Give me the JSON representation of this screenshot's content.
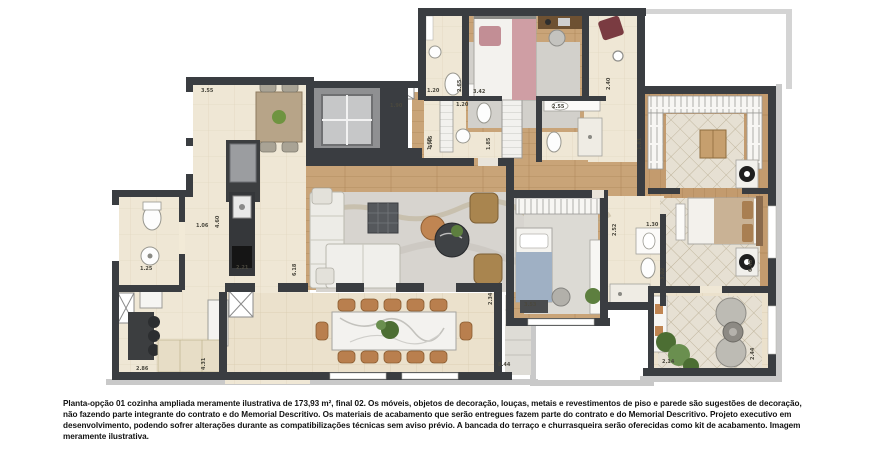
{
  "caption": {
    "text": "Planta-opção 01 cozinha ampliada meramente ilustrativa de 173,93 m², final 02. Os móveis, objetos de decoração, louças, metais e revestimentos de piso e parede são sugestões de decoração, não fazendo parte integrante do contrato e do Memorial Descritivo. Os materiais de acabamento que serão entregues fazem parte do contrato e do Memorial Descritivo. Projeto executivo em desenvolvimento, podendo sofrer alterações durante as compatibilizações técnicas sem aviso prévio. A bancada do terraço e churrasqueira serão oferecidas como kit de acabamento. Imagem meramente ilustrativa."
  },
  "floorplan": {
    "type": "apartment-floor-plan",
    "option_label": "Planta-opção 01",
    "area_label": "173,93 m²",
    "unit_label": "final 02",
    "colors": {
      "wall": "#3a3d41",
      "tile_floor": "#ebe1cc",
      "wood_floor": "#c9a478",
      "rug_gray": "#d7d4cf",
      "rug_diamond": "#e6e0d3",
      "accent_pink": "#d9a8ab",
      "accent_blue": "#9fb0c4",
      "furniture_tan": "#b97f4e",
      "greenery": "#5d7f3f",
      "exterior_trim": "#c9c9c9"
    },
    "dimension_labels": [
      {
        "v": "3.55",
        "x": 201,
        "y": 92,
        "rot": false
      },
      {
        "v": "1.90",
        "x": 390,
        "y": 107,
        "rot": false
      },
      {
        "v": "1.45",
        "x": 432,
        "y": 148,
        "rot": true
      },
      {
        "v": "1.20",
        "x": 427,
        "y": 92,
        "rot": false
      },
      {
        "v": "2.65",
        "x": 461,
        "y": 92,
        "rot": true
      },
      {
        "v": "3.42",
        "x": 473,
        "y": 93,
        "rot": false
      },
      {
        "v": "1.20",
        "x": 456,
        "y": 106,
        "rot": false
      },
      {
        "v": "1.65",
        "x": 431,
        "y": 150,
        "rot": true
      },
      {
        "v": "1.85",
        "x": 490,
        "y": 150,
        "rot": true
      },
      {
        "v": "2.55",
        "x": 552,
        "y": 108,
        "rot": false
      },
      {
        "v": "2.40",
        "x": 610,
        "y": 90,
        "rot": true
      },
      {
        "v": "1.81",
        "x": 641,
        "y": 150,
        "rot": true
      },
      {
        "v": "1.06",
        "x": 196,
        "y": 227,
        "rot": false
      },
      {
        "v": "4.60",
        "x": 219,
        "y": 228,
        "rot": true
      },
      {
        "v": "1.25",
        "x": 140,
        "y": 270,
        "rot": false
      },
      {
        "v": "2.21",
        "x": 236,
        "y": 269,
        "rot": false
      },
      {
        "v": "2.86",
        "x": 136,
        "y": 370,
        "rot": false
      },
      {
        "v": "4.31",
        "x": 205,
        "y": 370,
        "rot": true
      },
      {
        "v": "6.18",
        "x": 296,
        "y": 276,
        "rot": true
      },
      {
        "v": "2.34",
        "x": 492,
        "y": 305,
        "rot": true
      },
      {
        "v": "8.44",
        "x": 498,
        "y": 366,
        "rot": false
      },
      {
        "v": "3.53",
        "x": 524,
        "y": 306,
        "rot": false
      },
      {
        "v": "1.30",
        "x": 646,
        "y": 226,
        "rot": false
      },
      {
        "v": "2.52",
        "x": 616,
        "y": 236,
        "rot": true
      },
      {
        "v": "3.02",
        "x": 664,
        "y": 280,
        "rot": true
      },
      {
        "v": "6.48",
        "x": 752,
        "y": 272,
        "rot": true
      },
      {
        "v": "2.14",
        "x": 662,
        "y": 363,
        "rot": false
      },
      {
        "v": "2.44",
        "x": 754,
        "y": 360,
        "rot": true
      }
    ]
  }
}
